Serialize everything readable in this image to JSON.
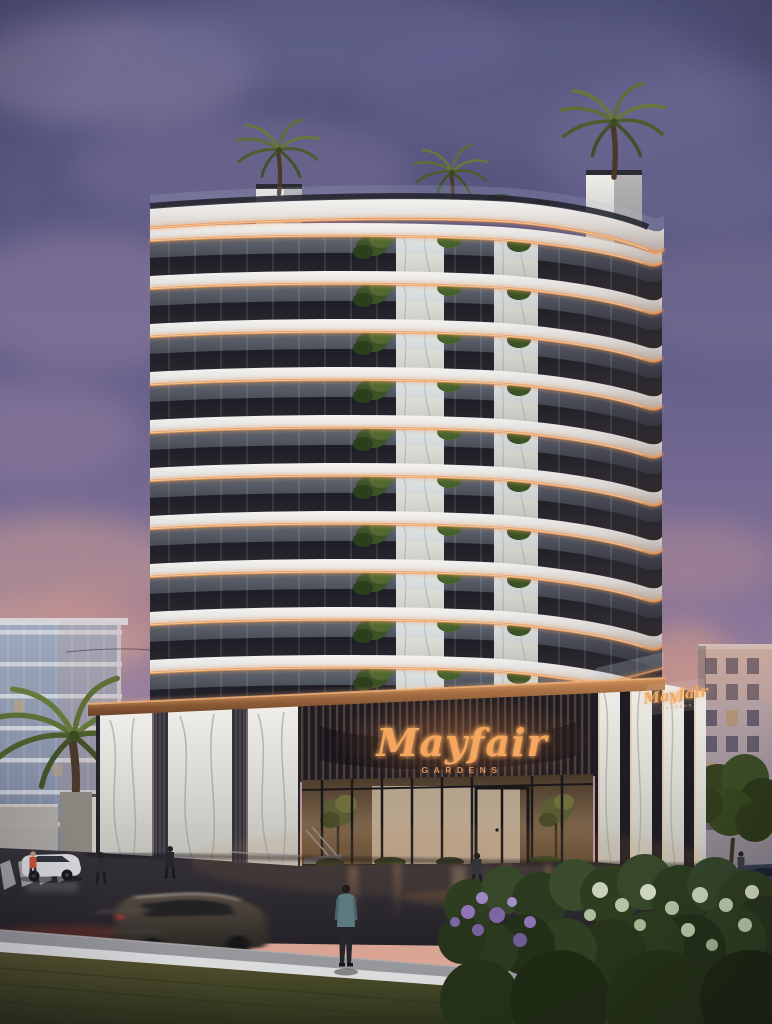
{
  "scene": {
    "type": "architectural rendering",
    "time_of_day": "dusk",
    "description": "Curved luxury residential tower with illuminated balcony edges, marble podium and rooftop palms at sunset"
  },
  "signage": {
    "main_name": "Mayfair",
    "main_subtitle": "GARDENS",
    "corner_name": "Mayfair",
    "corner_subtitle": "GARDENS"
  },
  "building": {
    "balcony_bands": 10,
    "band_spacing_px": 48,
    "first_band_y": 224,
    "rooftop_palms": 2,
    "podium_material": "book-matched marble with bronze slats"
  },
  "entities": {
    "pedestrians": 6,
    "vehicles": [
      "white suv parked left",
      "dark suv driving (motion blur)",
      "dark car at right edge"
    ],
    "vegetation": [
      "street palm left",
      "rooftop palms",
      "flower bush foreground",
      "green tree right"
    ]
  },
  "palette": {
    "sky_top": "#565878",
    "sky_mauve": "#8d7b9e",
    "sunset_pink": "#e2a58f",
    "slab_white": "#efeeec",
    "copper_glow": "#e8985c",
    "sign_glow": "#f6a75f",
    "glass_dark": "#1d1c24",
    "marble": "#d9d8d2",
    "road": "#2a272c",
    "grass": "#4a4a2c",
    "flower_purple": "#8f77b4"
  }
}
